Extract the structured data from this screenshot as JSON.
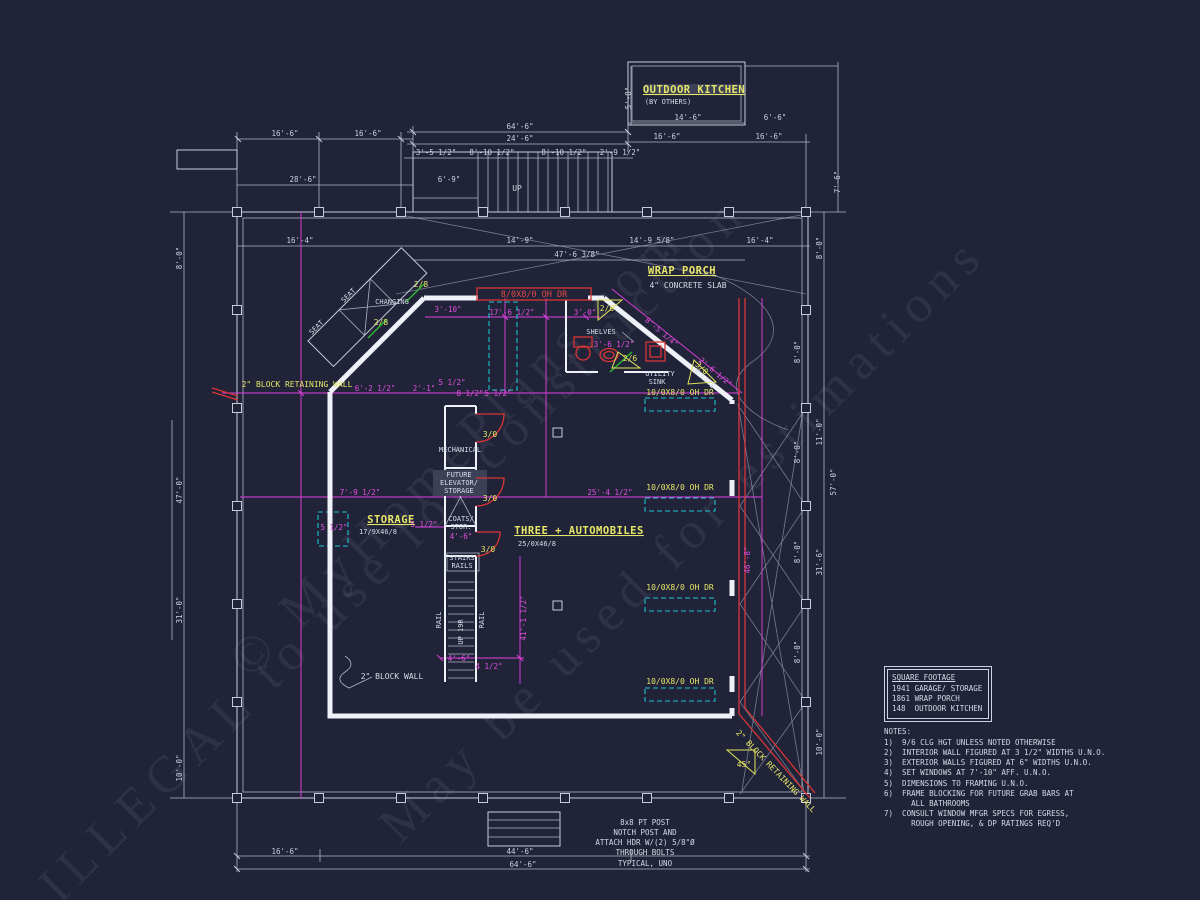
{
  "colors": {
    "background": "#212438",
    "walls": "#eef1f8",
    "dim_white": "#c9cfe0",
    "dim_magenta": "#e24fe2",
    "label_yellow": "#e6e668",
    "door_red": "#d93535",
    "track_cyan": "#1ac3cf",
    "door_green": "#2ab332"
  },
  "watermark": [
    "© MyHomePlans.com",
    "May be used for estimations",
    "ILLEGAL to use for construction"
  ],
  "square_footage": {
    "title": "SQUARE FOOTAGE",
    "rows": [
      "1941 GARAGE/ STORAGE",
      "1861 WRAP PORCH",
      "148  OUTDOOR KITCHEN"
    ]
  },
  "notes": {
    "title": "NOTES:",
    "lines": [
      "1)  9/6 CLG HGT UNLESS NOTED OTHERWISE",
      "2)  INTERIOR WALL FIGURED AT 3 1/2\" WIDTHS U.N.O.",
      "3)  EXTERIOR WALLS FIGURED AT 6\" WIDTHS U.N.O.",
      "4)  SET WINDOWS AT 7'-10\" AFF. U.N.O.",
      "5)  DIMENSIONS TO FRAMING U.N.O.",
      "6)  FRAME BLOCKING FOR FUTURE GRAB BARS AT",
      "      ALL BATHROOMS",
      "7)  CONSULT WINDOW MFGR SPECS FOR EGRESS,",
      "      ROUGH OPENING, & DP RATINGS REQ'D"
    ]
  },
  "post_note": {
    "lines": [
      "8x8 PT POST",
      "NOTCH POST AND",
      "ATTACH HDR W/(2) 5/8\"Ø",
      "THROUGH BOLTS",
      "TYPICAL, UNO"
    ]
  },
  "annotations": [
    {
      "t": "OUTDOOR KITCHEN",
      "x": 694,
      "y": 93,
      "c": "room",
      "n": "outdoor-kitchen-label"
    },
    {
      "t": "(BY OTHERS)",
      "x": 668,
      "y": 104,
      "c": "small",
      "n": "by-others-label"
    },
    {
      "t": "WRAP PORCH",
      "x": 682,
      "y": 274,
      "c": "room",
      "n": "wrap-porch-label"
    },
    {
      "t": "4\" CONCRETE SLAB",
      "x": 688,
      "y": 288,
      "c": "lblw",
      "n": "concrete-slab-label"
    },
    {
      "t": "STORAGE",
      "x": 391,
      "y": 523,
      "c": "room",
      "n": "storage-label"
    },
    {
      "t": "17/9X46/8",
      "x": 378,
      "y": 534,
      "c": "small",
      "n": "storage-size-label"
    },
    {
      "t": "THREE + AUTOMOBILES",
      "x": 579,
      "y": 534,
      "c": "room",
      "n": "three-automobiles-label"
    },
    {
      "t": "25/0X46/8",
      "x": 537,
      "y": 546,
      "c": "small",
      "n": "garage-size-label"
    },
    {
      "t": "2\" BLOCK RETAINING WALL",
      "x": 297,
      "y": 387,
      "c": "lbly",
      "n": "block-retaining-wall-label"
    },
    {
      "t": "2\" BLOCK RETAINING WALL",
      "x": 774,
      "y": 773,
      "r": 46,
      "c": "lbly",
      "n": "block-retaining-wall-label"
    },
    {
      "t": "2\" BLOCK WALL",
      "x": 392,
      "y": 679,
      "c": "lblw",
      "n": "block-wall-label"
    },
    {
      "t": "MECHANICAL",
      "x": 460,
      "y": 452,
      "c": "small",
      "n": "mechanical-label"
    },
    {
      "t": "FUTURE",
      "x": 459,
      "y": 477,
      "c": "small",
      "n": "future-elevator-label"
    },
    {
      "t": "ELEVATOR/",
      "x": 459,
      "y": 485,
      "c": "small",
      "n": "future-elevator-label"
    },
    {
      "t": "STORAGE",
      "x": 459,
      "y": 493,
      "c": "small",
      "n": "future-elevator-label"
    },
    {
      "t": "COATS/",
      "x": 461,
      "y": 521,
      "c": "small",
      "n": "coats-storage-label"
    },
    {
      "t": "STOR.",
      "x": 461,
      "y": 529,
      "c": "small",
      "n": "coats-storage-label"
    },
    {
      "t": "4'-6\"",
      "x": 461,
      "y": 539,
      "c": "dimm"
    },
    {
      "t": "STAIRS",
      "x": 462,
      "y": 560,
      "c": "small",
      "n": "stairs-label"
    },
    {
      "t": "RAILS",
      "x": 462,
      "y": 568,
      "c": "small",
      "n": "stairs-label"
    },
    {
      "t": "RAIL",
      "x": 441,
      "y": 620,
      "r": -90,
      "c": "small",
      "n": "rail-label"
    },
    {
      "t": "RAIL",
      "x": 484,
      "y": 620,
      "r": -90,
      "c": "small",
      "n": "rail-label"
    },
    {
      "t": "UP 19R",
      "x": 463,
      "y": 632,
      "r": -90,
      "c": "small",
      "n": "stair-direction-label"
    },
    {
      "t": "SEAT",
      "x": 350,
      "y": 297,
      "r": -45,
      "c": "small",
      "n": "seat-label"
    },
    {
      "t": "SEAT",
      "x": 318,
      "y": 329,
      "r": -45,
      "c": "small",
      "n": "seat-label"
    },
    {
      "t": "CHANGING",
      "x": 392,
      "y": 304,
      "c": "small",
      "n": "changing-label"
    },
    {
      "t": "SHELVES",
      "x": 601,
      "y": 334,
      "c": "small",
      "n": "shelves-label"
    },
    {
      "t": "UTILITY",
      "x": 660,
      "y": 376,
      "c": "small",
      "n": "utility-sink-label"
    },
    {
      "t": "SINK",
      "x": 657,
      "y": 384,
      "c": "small",
      "n": "utility-sink-label"
    },
    {
      "t": "UP",
      "x": 517,
      "y": 191,
      "c": "lblw",
      "n": "stair-up-label"
    },
    {
      "t": "45°",
      "x": 744,
      "y": 767,
      "c": "lbly",
      "n": "angle-label"
    },
    {
      "t": "3/0",
      "x": 490,
      "y": 437,
      "c": "lbly",
      "n": "door-size-label"
    },
    {
      "t": "3/0",
      "x": 490,
      "y": 501,
      "c": "lbly",
      "n": "door-size-label"
    },
    {
      "t": "3/0",
      "x": 488,
      "y": 552,
      "c": "lbly",
      "n": "door-size-label"
    },
    {
      "t": "2/8",
      "x": 421,
      "y": 287,
      "c": "lbly",
      "n": "door-size-label"
    },
    {
      "t": "2/8",
      "x": 381,
      "y": 325,
      "c": "lbly",
      "n": "door-size-label"
    },
    {
      "t": "2/6",
      "x": 607,
      "y": 311,
      "c": "lbly",
      "n": "door-size-label"
    },
    {
      "t": "2/6",
      "x": 630,
      "y": 361,
      "c": "lbly",
      "n": "door-size-label"
    },
    {
      "t": "3/0",
      "x": 700,
      "y": 370,
      "r": 43,
      "c": "lbly",
      "n": "door-size-label"
    },
    {
      "t": "W LITE",
      "x": 703,
      "y": 380,
      "r": 43,
      "c": "small",
      "n": "door-size-label"
    },
    {
      "t": "10/0X8/0 OH DR",
      "x": 680,
      "y": 395,
      "c": "lbly",
      "n": "overhead-door-label"
    },
    {
      "t": "10/0X8/0 OH DR",
      "x": 680,
      "y": 490,
      "c": "lbly",
      "n": "overhead-door-label"
    },
    {
      "t": "10/0X8/0 OH DR",
      "x": 680,
      "y": 590,
      "c": "lbly",
      "n": "overhead-door-label"
    },
    {
      "t": "10/0X8/0 OH DR",
      "x": 680,
      "y": 684,
      "c": "lbly",
      "n": "overhead-door-label"
    },
    {
      "t": "8/0X8/0 OH DR",
      "x": 534,
      "y": 297,
      "c": "lblr",
      "n": "overhead-door-label"
    },
    {
      "t": "16'-6\"",
      "x": 285,
      "y": 136,
      "c": "dimw"
    },
    {
      "t": "16'-6\"",
      "x": 368,
      "y": 136,
      "c": "dimw"
    },
    {
      "t": "28'-6\"",
      "x": 303,
      "y": 182,
      "c": "dimw"
    },
    {
      "t": "64'-6\"",
      "x": 520,
      "y": 129,
      "c": "dimw"
    },
    {
      "t": "24'-6\"",
      "x": 520,
      "y": 141,
      "c": "dimw"
    },
    {
      "t": "3'-5 1/2\"",
      "x": 436,
      "y": 155,
      "c": "dimw"
    },
    {
      "t": "8'-10 1/2\"",
      "x": 492,
      "y": 155,
      "c": "dimw"
    },
    {
      "t": "8'-10 1/2\"",
      "x": 564,
      "y": 155,
      "c": "dimw"
    },
    {
      "t": "2'-9 1/2\"",
      "x": 620,
      "y": 155,
      "c": "dimw"
    },
    {
      "t": "6'-9\"",
      "x": 449,
      "y": 182,
      "c": "dimw"
    },
    {
      "t": "14'-6\"",
      "x": 688,
      "y": 120,
      "c": "dimw"
    },
    {
      "t": "6'-6\"",
      "x": 775,
      "y": 120,
      "c": "dimw"
    },
    {
      "t": "16'-6\"",
      "x": 667,
      "y": 139,
      "c": "dimw"
    },
    {
      "t": "16'-6\"",
      "x": 769,
      "y": 139,
      "c": "dimw"
    },
    {
      "t": "5'-0\"",
      "x": 631,
      "y": 98,
      "r": -90,
      "c": "dimw"
    },
    {
      "t": "7'-6\"",
      "x": 840,
      "y": 182,
      "r": -90,
      "c": "dimw"
    },
    {
      "t": "16'-4\"",
      "x": 300,
      "y": 243,
      "c": "dimw"
    },
    {
      "t": "14'-9\"",
      "x": 520,
      "y": 243,
      "c": "dimw"
    },
    {
      "t": "47'-6 3/8\"",
      "x": 577,
      "y": 257,
      "c": "dimw"
    },
    {
      "t": "14'-9 5/8\"",
      "x": 652,
      "y": 243,
      "c": "dimw"
    },
    {
      "t": "16'-4\"",
      "x": 760,
      "y": 243,
      "c": "dimw"
    },
    {
      "t": "16'-6\"",
      "x": 285,
      "y": 854,
      "c": "dimw"
    },
    {
      "t": "44'-6\"",
      "x": 520,
      "y": 854,
      "c": "dimw"
    },
    {
      "t": "64'-6\"",
      "x": 523,
      "y": 867,
      "c": "dimw"
    },
    {
      "t": "8'-0\"",
      "x": 182,
      "y": 258,
      "r": -90,
      "c": "dimw"
    },
    {
      "t": "47'-0\"",
      "x": 182,
      "y": 490,
      "r": -90,
      "c": "dimw"
    },
    {
      "t": "31'-0\"",
      "x": 182,
      "y": 610,
      "r": -90,
      "c": "dimw"
    },
    {
      "t": "10'-0\"",
      "x": 182,
      "y": 768,
      "r": -90,
      "c": "dimw"
    },
    {
      "t": "8'-0\"",
      "x": 822,
      "y": 248,
      "r": -90,
      "c": "dimw"
    },
    {
      "t": "11'-0\"",
      "x": 822,
      "y": 432,
      "r": -90,
      "c": "dimw"
    },
    {
      "t": "57'-0\"",
      "x": 836,
      "y": 482,
      "r": -90,
      "c": "dimw"
    },
    {
      "t": "31'-6\"",
      "x": 822,
      "y": 562,
      "r": -90,
      "c": "dimw"
    },
    {
      "t": "10'-0\"",
      "x": 822,
      "y": 742,
      "r": -90,
      "c": "dimw"
    },
    {
      "t": "8'-0\"",
      "x": 800,
      "y": 352,
      "r": -90,
      "c": "dimw"
    },
    {
      "t": "8'-0\"",
      "x": 800,
      "y": 452,
      "r": -90,
      "c": "dimw"
    },
    {
      "t": "8'-0\"",
      "x": 800,
      "y": 552,
      "r": -90,
      "c": "dimw"
    },
    {
      "t": "8'-0\"",
      "x": 800,
      "y": 652,
      "r": -90,
      "c": "dimw"
    },
    {
      "t": "17'-6 1/2\"",
      "x": 512,
      "y": 315,
      "c": "dimm"
    },
    {
      "t": "3'-0\"",
      "x": 585,
      "y": 315,
      "c": "dimm"
    },
    {
      "t": "3'-10\"",
      "x": 448,
      "y": 312,
      "c": "dimm"
    },
    {
      "t": "6'-2 1/2\"",
      "x": 375,
      "y": 391,
      "c": "dimm"
    },
    {
      "t": "2'-1\"",
      "x": 424,
      "y": 391,
      "c": "dimm"
    },
    {
      "t": "5 1/2\"",
      "x": 452,
      "y": 385,
      "c": "dimm"
    },
    {
      "t": "8 1/2\"",
      "x": 470,
      "y": 396,
      "c": "dimm"
    },
    {
      "t": "5 1/2\"",
      "x": 498,
      "y": 396,
      "c": "dimm"
    },
    {
      "t": "8'-5 1/4\"",
      "x": 660,
      "y": 334,
      "r": 40,
      "c": "dimm"
    },
    {
      "t": "2'-6 1/2\"",
      "x": 714,
      "y": 374,
      "r": 40,
      "c": "dimm"
    },
    {
      "t": "3'-6 1/2\"",
      "x": 614,
      "y": 347,
      "c": "dimm"
    },
    {
      "t": "7'-9 1/2\"",
      "x": 360,
      "y": 495,
      "c": "dimm"
    },
    {
      "t": "25'-4 1/2\"",
      "x": 610,
      "y": 495,
      "c": "dimm"
    },
    {
      "t": "5 1/2\"",
      "x": 424,
      "y": 527,
      "c": "dimm"
    },
    {
      "t": "5 1/2\"",
      "x": 334,
      "y": 530,
      "c": "dimm"
    },
    {
      "t": "41'-1 1/2\"",
      "x": 526,
      "y": 618,
      "r": -90,
      "c": "dimm"
    },
    {
      "t": "4'-6\"",
      "x": 459,
      "y": 661,
      "c": "dimm"
    },
    {
      "t": "4 1/2\"",
      "x": 489,
      "y": 669,
      "c": "dimm"
    },
    {
      "t": "46'-8\"",
      "x": 750,
      "y": 560,
      "r": -90,
      "c": "dimm"
    }
  ]
}
